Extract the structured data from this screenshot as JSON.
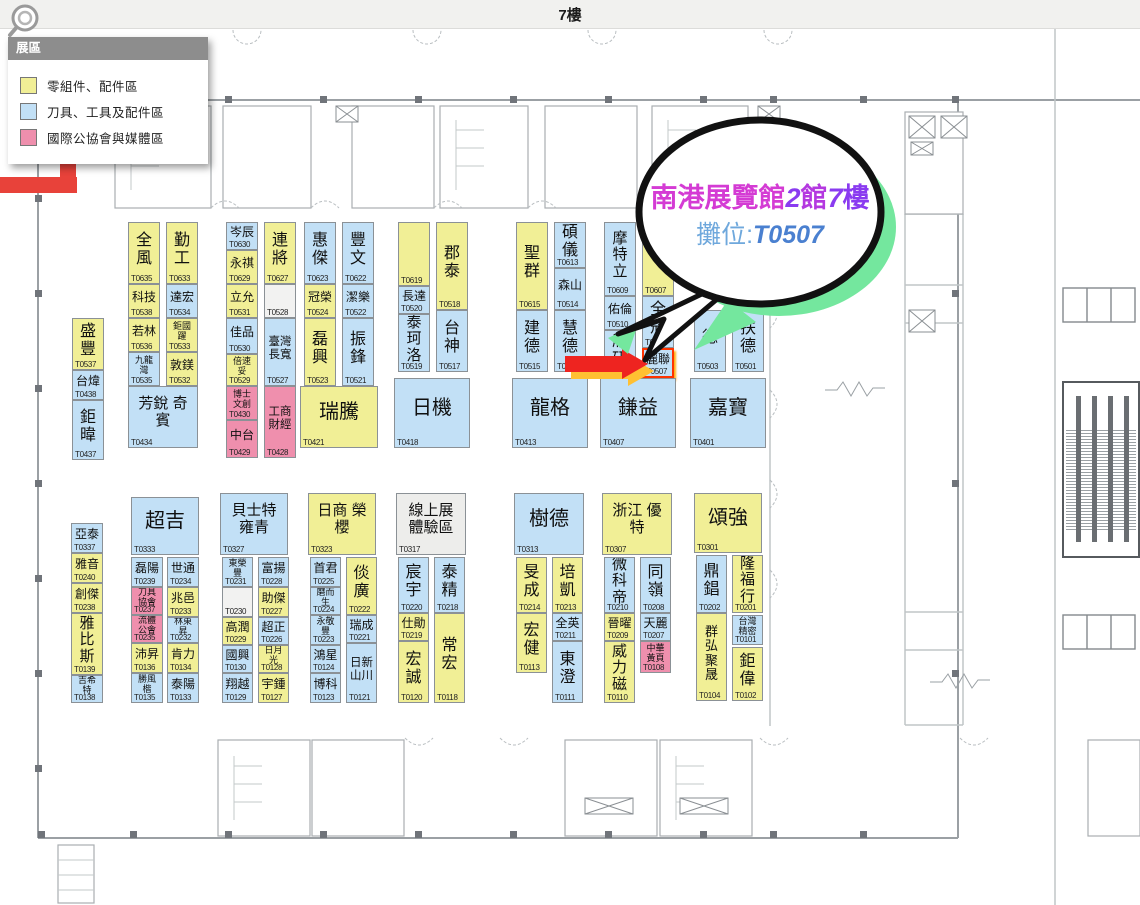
{
  "title_bar": {
    "label": "7樓"
  },
  "legend": {
    "header": "展區",
    "items": [
      {
        "label": "零組件、配件區",
        "color_key": "yellow"
      },
      {
        "label": "刀具、工具及配件區",
        "color_key": "blue"
      },
      {
        "label": "國際公協會與媒體區",
        "color_key": "pink"
      }
    ]
  },
  "callout": {
    "parts": [
      "南港展覽館",
      "2",
      "館",
      "7",
      "樓"
    ],
    "booth_prefix": "攤位:",
    "booth_no": "T0507"
  },
  "colors": {
    "yellow": "#f1ef96",
    "blue": "#c2e0f6",
    "pink": "#ef8fad",
    "empty": "#f2f2f1",
    "gray": "#ededeb",
    "arrow_red": "#ee2420",
    "arrow_glow": "#ffc032",
    "route_red": "#e8423a",
    "bubble_green": "#74e79e",
    "callout_magenta": "#d43bd4",
    "callout_purple": "#8a3bf0",
    "callout_mid": "#b438e0",
    "callout_blue": "#6fa8dc",
    "callout_booth_blue": "#4a80d0"
  },
  "booths": [
    {
      "num": "T0537",
      "name": "盛豐",
      "x": 72,
      "y": 318,
      "w": 32,
      "h": 52,
      "c": "y"
    },
    {
      "num": "T0438",
      "name": "台煒",
      "x": 72,
      "y": 370,
      "w": 32,
      "h": 30,
      "c": "b"
    },
    {
      "num": "T0437",
      "name": "鉅暐",
      "x": 72,
      "y": 400,
      "w": 32,
      "h": 60,
      "c": "b"
    },
    {
      "num": "T0635",
      "name": "全風",
      "x": 128,
      "y": 222,
      "w": 32,
      "h": 62,
      "c": "y"
    },
    {
      "num": "T0633",
      "name": "勤工",
      "x": 166,
      "y": 222,
      "w": 32,
      "h": 62,
      "c": "y"
    },
    {
      "num": "T0538",
      "name": "科技",
      "x": 128,
      "y": 284,
      "w": 32,
      "h": 34,
      "c": "y"
    },
    {
      "num": "T0534",
      "name": "達宏",
      "x": 166,
      "y": 284,
      "w": 32,
      "h": 34,
      "c": "b"
    },
    {
      "num": "T0536",
      "name": "若林",
      "x": 128,
      "y": 318,
      "w": 32,
      "h": 34,
      "c": "y"
    },
    {
      "num": "T0533",
      "name": "鉅國躍",
      "x": 166,
      "y": 318,
      "w": 32,
      "h": 34,
      "c": "y"
    },
    {
      "num": "T0535",
      "name": "九龍灣",
      "x": 128,
      "y": 352,
      "w": 32,
      "h": 34,
      "c": "b"
    },
    {
      "num": "T0532",
      "name": "敦鎂",
      "x": 166,
      "y": 352,
      "w": 32,
      "h": 34,
      "c": "y"
    },
    {
      "num": "T0434",
      "name": "芳銳 奇賓",
      "x": 128,
      "y": 386,
      "w": 70,
      "h": 62,
      "c": "b",
      "big": true
    },
    {
      "num": "T0630",
      "name": "岑辰",
      "x": 226,
      "y": 222,
      "w": 32,
      "h": 28,
      "c": "b"
    },
    {
      "num": "T0629",
      "name": "永祺",
      "x": 226,
      "y": 250,
      "w": 32,
      "h": 34,
      "c": "y"
    },
    {
      "num": "T0531",
      "name": "立允",
      "x": 226,
      "y": 284,
      "w": 32,
      "h": 34,
      "c": "y"
    },
    {
      "num": "T0530",
      "name": "佳品",
      "x": 226,
      "y": 318,
      "w": 32,
      "h": 36,
      "c": "b"
    },
    {
      "num": "T0529",
      "name": "倍速妥",
      "x": 226,
      "y": 354,
      "w": 32,
      "h": 32,
      "c": "y"
    },
    {
      "num": "T0430",
      "name": "博士文創",
      "x": 226,
      "y": 386,
      "w": 32,
      "h": 34,
      "c": "p"
    },
    {
      "num": "T0429",
      "name": "中台",
      "x": 226,
      "y": 420,
      "w": 32,
      "h": 38,
      "c": "p"
    },
    {
      "num": "T0627",
      "name": "連將",
      "x": 264,
      "y": 222,
      "w": 32,
      "h": 62,
      "c": "y"
    },
    {
      "num": "T0528",
      "name": "",
      "x": 264,
      "y": 284,
      "w": 32,
      "h": 34,
      "c": "e"
    },
    {
      "num": "T0527",
      "name": "臺灣長寬",
      "x": 264,
      "y": 318,
      "w": 32,
      "h": 68,
      "c": "b"
    },
    {
      "num": "T0428",
      "name": "工商財經",
      "x": 264,
      "y": 386,
      "w": 32,
      "h": 72,
      "c": "p"
    },
    {
      "num": "T0623",
      "name": "惠傑",
      "x": 304,
      "y": 222,
      "w": 32,
      "h": 62,
      "c": "b"
    },
    {
      "num": "T0622",
      "name": "豐文",
      "x": 342,
      "y": 222,
      "w": 32,
      "h": 62,
      "c": "b"
    },
    {
      "num": "T0524",
      "name": "冠榮",
      "x": 304,
      "y": 284,
      "w": 32,
      "h": 34,
      "c": "y"
    },
    {
      "num": "T0522",
      "name": "潔樂",
      "x": 342,
      "y": 284,
      "w": 32,
      "h": 34,
      "c": "b"
    },
    {
      "num": "T0523",
      "name": "磊興",
      "x": 304,
      "y": 318,
      "w": 32,
      "h": 68,
      "c": "y"
    },
    {
      "num": "T0521",
      "name": "振鋒",
      "x": 342,
      "y": 318,
      "w": 32,
      "h": 68,
      "c": "b"
    },
    {
      "num": "T0421",
      "name": "瑞騰",
      "x": 300,
      "y": 386,
      "w": 78,
      "h": 62,
      "c": "y",
      "big": true
    },
    {
      "num": "T0619",
      "name": "",
      "x": 398,
      "y": 222,
      "w": 32,
      "h": 64,
      "c": "y"
    },
    {
      "num": "T0520",
      "name": "長達",
      "x": 398,
      "y": 286,
      "w": 32,
      "h": 28,
      "c": "b"
    },
    {
      "num": "T0519",
      "name": "泰珂洛",
      "x": 398,
      "y": 314,
      "w": 32,
      "h": 58,
      "c": "b"
    },
    {
      "num": "T0518",
      "name": "郡泰",
      "x": 436,
      "y": 222,
      "w": 32,
      "h": 88,
      "c": "y"
    },
    {
      "num": "T0517",
      "name": "台神",
      "x": 436,
      "y": 310,
      "w": 32,
      "h": 62,
      "c": "b"
    },
    {
      "num": "T0418",
      "name": "日機",
      "x": 394,
      "y": 378,
      "w": 76,
      "h": 70,
      "c": "b",
      "big": true
    },
    {
      "num": "T0615",
      "name": "聖群",
      "x": 516,
      "y": 222,
      "w": 32,
      "h": 88,
      "c": "y"
    },
    {
      "num": "T0613",
      "name": "碩儀",
      "x": 554,
      "y": 222,
      "w": 32,
      "h": 46,
      "c": "b"
    },
    {
      "num": "T0514",
      "name": "森山",
      "x": 554,
      "y": 268,
      "w": 32,
      "h": 42,
      "c": "b"
    },
    {
      "num": "T0515",
      "name": "建德",
      "x": 516,
      "y": 310,
      "w": 32,
      "h": 62,
      "c": "b"
    },
    {
      "num": "T0513",
      "name": "慧德",
      "x": 554,
      "y": 310,
      "w": 32,
      "h": 62,
      "c": "b"
    },
    {
      "num": "T0413",
      "name": "龍格",
      "x": 512,
      "y": 378,
      "w": 76,
      "h": 70,
      "c": "b",
      "big": true
    },
    {
      "num": "T0609",
      "name": "摩特立",
      "x": 604,
      "y": 222,
      "w": 32,
      "h": 74,
      "c": "b"
    },
    {
      "num": "T0607",
      "name": "",
      "x": 642,
      "y": 222,
      "w": 32,
      "h": 74,
      "c": "y"
    },
    {
      "num": "T0510",
      "name": "佑倫",
      "x": 604,
      "y": 296,
      "w": 32,
      "h": 34,
      "c": "b"
    },
    {
      "num": "T0509",
      "name": "欣研",
      "x": 604,
      "y": 330,
      "w": 32,
      "h": 48,
      "c": "b"
    },
    {
      "num": "T0508",
      "name": "全冠",
      "x": 642,
      "y": 296,
      "w": 32,
      "h": 52,
      "c": "b"
    },
    {
      "num": "T0507",
      "name": "麗聯",
      "x": 642,
      "y": 348,
      "w": 32,
      "h": 30,
      "c": "b",
      "hl": true
    },
    {
      "num": "T0407",
      "name": "鎌益",
      "x": 600,
      "y": 378,
      "w": 76,
      "h": 70,
      "c": "b",
      "big": true
    },
    {
      "num": "T0503",
      "name": "德",
      "x": 694,
      "y": 310,
      "w": 32,
      "h": 62,
      "c": "b"
    },
    {
      "num": "T0501",
      "name": "扶德",
      "x": 732,
      "y": 310,
      "w": 32,
      "h": 62,
      "c": "b"
    },
    {
      "num": "T0401",
      "name": "嘉寶",
      "x": 690,
      "y": 378,
      "w": 76,
      "h": 70,
      "c": "b",
      "big": true
    },
    {
      "num": "T0337",
      "name": "亞泰",
      "x": 71,
      "y": 523,
      "w": 32,
      "h": 30,
      "c": "b"
    },
    {
      "num": "T0240",
      "name": "雅音",
      "x": 71,
      "y": 553,
      "w": 32,
      "h": 30,
      "c": "y"
    },
    {
      "num": "T0238",
      "name": "創傑",
      "x": 71,
      "y": 583,
      "w": 32,
      "h": 30,
      "c": "y"
    },
    {
      "num": "T0139",
      "name": "雅比斯",
      "x": 71,
      "y": 613,
      "w": 32,
      "h": 62,
      "c": "y"
    },
    {
      "num": "T0138",
      "name": "吉希特",
      "x": 71,
      "y": 675,
      "w": 32,
      "h": 28,
      "c": "b"
    },
    {
      "num": "T0333",
      "name": "超吉",
      "x": 131,
      "y": 497,
      "w": 68,
      "h": 58,
      "c": "b",
      "big": true
    },
    {
      "num": "T0239",
      "name": "磊陽",
      "x": 131,
      "y": 557,
      "w": 32,
      "h": 30,
      "c": "b"
    },
    {
      "num": "T0237",
      "name": "刀具協會",
      "x": 131,
      "y": 587,
      "w": 32,
      "h": 28,
      "c": "p"
    },
    {
      "num": "T0235",
      "name": "流體公會",
      "x": 131,
      "y": 615,
      "w": 32,
      "h": 28,
      "c": "p"
    },
    {
      "num": "T0136",
      "name": "沛昇",
      "x": 131,
      "y": 643,
      "w": 32,
      "h": 30,
      "c": "y"
    },
    {
      "num": "T0135",
      "name": "勝風楷",
      "x": 131,
      "y": 673,
      "w": 32,
      "h": 30,
      "c": "b"
    },
    {
      "num": "T0234",
      "name": "世通",
      "x": 167,
      "y": 557,
      "w": 32,
      "h": 30,
      "c": "b"
    },
    {
      "num": "T0233",
      "name": "兆邑",
      "x": 167,
      "y": 587,
      "w": 32,
      "h": 30,
      "c": "y"
    },
    {
      "num": "T0232",
      "name": "林東昇",
      "x": 167,
      "y": 617,
      "w": 32,
      "h": 26,
      "c": "b"
    },
    {
      "num": "T0134",
      "name": "肯力",
      "x": 167,
      "y": 643,
      "w": 32,
      "h": 30,
      "c": "y"
    },
    {
      "num": "T0133",
      "name": "泰陽",
      "x": 167,
      "y": 673,
      "w": 32,
      "h": 30,
      "c": "b"
    },
    {
      "num": "T0327",
      "name": "貝士特 雍青",
      "x": 220,
      "y": 493,
      "w": 68,
      "h": 62,
      "c": "b",
      "big": true
    },
    {
      "num": "T0231",
      "name": "東榮豐",
      "x": 222,
      "y": 557,
      "w": 31,
      "h": 30,
      "c": "b"
    },
    {
      "num": "T0230",
      "name": "",
      "x": 222,
      "y": 587,
      "w": 31,
      "h": 30,
      "c": "e"
    },
    {
      "num": "T0229",
      "name": "高潤",
      "x": 222,
      "y": 617,
      "w": 31,
      "h": 28,
      "c": "y"
    },
    {
      "num": "T0130",
      "name": "國興",
      "x": 222,
      "y": 645,
      "w": 31,
      "h": 28,
      "c": "b"
    },
    {
      "num": "T0129",
      "name": "翔越",
      "x": 222,
      "y": 673,
      "w": 31,
      "h": 30,
      "c": "b"
    },
    {
      "num": "T0228",
      "name": "富揚",
      "x": 258,
      "y": 557,
      "w": 31,
      "h": 30,
      "c": "b"
    },
    {
      "num": "T0227",
      "name": "助傑",
      "x": 258,
      "y": 587,
      "w": 31,
      "h": 30,
      "c": "y"
    },
    {
      "num": "T0226",
      "name": "超正",
      "x": 258,
      "y": 617,
      "w": 31,
      "h": 28,
      "c": "b"
    },
    {
      "num": "T0128",
      "name": "日月光",
      "x": 258,
      "y": 645,
      "w": 31,
      "h": 28,
      "c": "y"
    },
    {
      "num": "T0127",
      "name": "宇鍾",
      "x": 258,
      "y": 673,
      "w": 31,
      "h": 30,
      "c": "y"
    },
    {
      "num": "T0323",
      "name": "日商 榮櫻",
      "x": 308,
      "y": 493,
      "w": 68,
      "h": 62,
      "c": "y",
      "big": true
    },
    {
      "num": "T0225",
      "name": "首君",
      "x": 310,
      "y": 557,
      "w": 31,
      "h": 30,
      "c": "b"
    },
    {
      "num": "T0224",
      "name": "磨而生",
      "x": 310,
      "y": 587,
      "w": 31,
      "h": 28,
      "c": "b"
    },
    {
      "num": "T0223",
      "name": "永敬豐",
      "x": 310,
      "y": 615,
      "w": 31,
      "h": 30,
      "c": "b"
    },
    {
      "num": "T0124",
      "name": "鴻星",
      "x": 310,
      "y": 645,
      "w": 31,
      "h": 28,
      "c": "b"
    },
    {
      "num": "T0123",
      "name": "博科",
      "x": 310,
      "y": 673,
      "w": 31,
      "h": 30,
      "c": "b"
    },
    {
      "num": "T0222",
      "name": "倓廣",
      "x": 346,
      "y": 557,
      "w": 31,
      "h": 58,
      "c": "y"
    },
    {
      "num": "T0221",
      "name": "瑞成",
      "x": 346,
      "y": 615,
      "w": 31,
      "h": 28,
      "c": "b"
    },
    {
      "num": "T0121",
      "name": "日新山川",
      "x": 346,
      "y": 643,
      "w": 31,
      "h": 60,
      "c": "b"
    },
    {
      "num": "T0317",
      "name": "線上展 體驗區",
      "x": 396,
      "y": 493,
      "w": 70,
      "h": 62,
      "c": "g",
      "big": true
    },
    {
      "num": "T0220",
      "name": "宸宇",
      "x": 398,
      "y": 557,
      "w": 31,
      "h": 56,
      "c": "b"
    },
    {
      "num": "T0219",
      "name": "仕勛",
      "x": 398,
      "y": 613,
      "w": 31,
      "h": 28,
      "c": "y"
    },
    {
      "num": "T0120",
      "name": "宏誠",
      "x": 398,
      "y": 641,
      "w": 31,
      "h": 62,
      "c": "y"
    },
    {
      "num": "T0218",
      "name": "泰精",
      "x": 434,
      "y": 557,
      "w": 31,
      "h": 56,
      "c": "b"
    },
    {
      "num": "T0118",
      "name": "常宏",
      "x": 434,
      "y": 613,
      "w": 31,
      "h": 90,
      "c": "y"
    },
    {
      "num": "T0313",
      "name": "樹德",
      "x": 514,
      "y": 493,
      "w": 70,
      "h": 62,
      "c": "b",
      "big": true
    },
    {
      "num": "T0214",
      "name": "旻成",
      "x": 516,
      "y": 557,
      "w": 31,
      "h": 56,
      "c": "y"
    },
    {
      "num": "T0113",
      "name": "宏健",
      "x": 516,
      "y": 613,
      "w": 31,
      "h": 60,
      "c": "y"
    },
    {
      "num": "T0213",
      "name": "培凱",
      "x": 552,
      "y": 557,
      "w": 31,
      "h": 56,
      "c": "y"
    },
    {
      "num": "T0211",
      "name": "全英",
      "x": 552,
      "y": 613,
      "w": 31,
      "h": 28,
      "c": "b"
    },
    {
      "num": "T0111",
      "name": "東澄",
      "x": 552,
      "y": 641,
      "w": 31,
      "h": 62,
      "c": "b"
    },
    {
      "num": "T0307",
      "name": "浙江 優特",
      "x": 602,
      "y": 493,
      "w": 70,
      "h": 62,
      "c": "y",
      "big": true
    },
    {
      "num": "T0210",
      "name": "微科帝",
      "x": 604,
      "y": 557,
      "w": 31,
      "h": 56,
      "c": "b"
    },
    {
      "num": "T0209",
      "name": "晉曜",
      "x": 604,
      "y": 613,
      "w": 31,
      "h": 28,
      "c": "y"
    },
    {
      "num": "T0110",
      "name": "威力磁",
      "x": 604,
      "y": 641,
      "w": 31,
      "h": 62,
      "c": "y"
    },
    {
      "num": "T0208",
      "name": "同嶺",
      "x": 640,
      "y": 557,
      "w": 31,
      "h": 56,
      "c": "b"
    },
    {
      "num": "T0207",
      "name": "天麗",
      "x": 640,
      "y": 613,
      "w": 31,
      "h": 28,
      "c": "b"
    },
    {
      "num": "T0108",
      "name": "中華黃頁",
      "x": 640,
      "y": 641,
      "w": 31,
      "h": 32,
      "c": "p"
    },
    {
      "num": "T0301",
      "name": "頌強",
      "x": 694,
      "y": 493,
      "w": 68,
      "h": 60,
      "c": "y",
      "big": true
    },
    {
      "num": "T0202",
      "name": "鼎錩",
      "x": 696,
      "y": 555,
      "w": 31,
      "h": 58,
      "c": "b"
    },
    {
      "num": "T0104",
      "name": "群弘 聚晟",
      "x": 696,
      "y": 613,
      "w": 31,
      "h": 88,
      "c": "y"
    },
    {
      "num": "T0201",
      "name": "隆福行",
      "x": 732,
      "y": 555,
      "w": 31,
      "h": 58,
      "c": "y"
    },
    {
      "num": "T0101",
      "name": "台灣精密",
      "x": 732,
      "y": 615,
      "w": 31,
      "h": 30,
      "c": "b"
    },
    {
      "num": "T0102",
      "name": "鉅偉",
      "x": 732,
      "y": 647,
      "w": 31,
      "h": 54,
      "c": "y"
    }
  ]
}
